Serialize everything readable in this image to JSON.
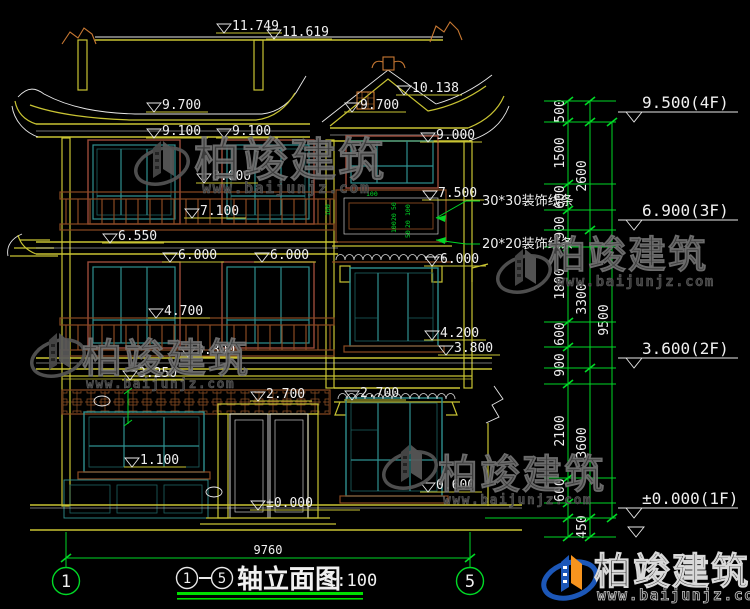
{
  "meta": {
    "drawing_kind": "architectural front elevation, CAD style",
    "sheet_background": "#000000"
  },
  "palette": {
    "bg": "#000000",
    "yellow": "#c8c333",
    "white": "#e8e8e8",
    "green": "#00d926",
    "teal": "#2f8f8f",
    "glass": "#1d6363",
    "maroon": "#9a4a3a",
    "brown": "#8a4a22",
    "orange": "#c87832",
    "wm_gray": "#424242",
    "wm_gray_stroke": "#757575",
    "logo_blue": "#1c57b8",
    "logo_orange": "#f7941e",
    "underline_green": "#00e000",
    "text_white": "#f0f0f0"
  },
  "title": {
    "axis_from": "1",
    "axis_to": "5",
    "name": "轴立面图",
    "scale": "1:100"
  },
  "grid_bubbles": [
    {
      "label": "1",
      "x": 66
    },
    {
      "label": "5",
      "x": 470
    }
  ],
  "bottom_dim": {
    "label": "9760"
  },
  "watermark": {
    "brand": "柏竣建筑",
    "url": "www.baijunjz.com"
  },
  "elevation_marks": [
    {
      "label": "11.749",
      "x": 216,
      "y": 33,
      "len": 66
    },
    {
      "label": "11.619",
      "x": 266,
      "y": 39,
      "len": 66
    },
    {
      "label": "9.700",
      "x": 146,
      "y": 112
    },
    {
      "label": "9.700",
      "x": 344,
      "y": 112
    },
    {
      "label": "10.138",
      "x": 396,
      "y": 95,
      "len": 66
    },
    {
      "label": "9.100",
      "x": 146,
      "y": 138
    },
    {
      "label": "9.100",
      "x": 216,
      "y": 138
    },
    {
      "label": "9.000",
      "x": 420,
      "y": 142
    },
    {
      "label": "8.000",
      "x": 196,
      "y": 183
    },
    {
      "label": "7.500",
      "x": 422,
      "y": 200
    },
    {
      "label": "7.100",
      "x": 184,
      "y": 218
    },
    {
      "label": "6.550",
      "x": 102,
      "y": 243
    },
    {
      "label": "6.000",
      "x": 162,
      "y": 262
    },
    {
      "label": "6.000",
      "x": 254,
      "y": 262
    },
    {
      "label": "6.000",
      "x": 424,
      "y": 266
    },
    {
      "label": "4.700",
      "x": 148,
      "y": 318
    },
    {
      "label": "4.200",
      "x": 424,
      "y": 340
    },
    {
      "label": "3.800",
      "x": 180,
      "y": 357
    },
    {
      "label": "3.800",
      "x": 438,
      "y": 355
    },
    {
      "label": "3.250",
      "x": 122,
      "y": 380
    },
    {
      "label": "2.700",
      "x": 250,
      "y": 401
    },
    {
      "label": "2.700",
      "x": 344,
      "y": 400
    },
    {
      "label": "1.100",
      "x": 124,
      "y": 467
    },
    {
      "label": "0.600",
      "x": 420,
      "y": 492
    },
    {
      "label": "±0.000",
      "x": 250,
      "y": 510,
      "len": 110
    }
  ],
  "leader_notes": [
    {
      "label": "30*30装饰线条",
      "tx": 482,
      "ty": 205,
      "ax": 436,
      "ay": 218
    },
    {
      "label": "20*20装饰线条",
      "tx": 482,
      "ty": 248,
      "ax": 436,
      "ay": 240
    }
  ],
  "level_flags": [
    {
      "label": "9.500(4F)",
      "y": 122
    },
    {
      "label": "6.900(3F)",
      "y": 230
    },
    {
      "label": "3.600(2F)",
      "y": 368
    },
    {
      "label": "±0.000(1F)",
      "y": 518
    }
  ],
  "dim_chains": [
    {
      "x": 568,
      "ticks": [
        101,
        122,
        184,
        210,
        247,
        322,
        347,
        384,
        478,
        503,
        518,
        537
      ],
      "labels": [
        [
          "500",
          111
        ],
        [
          "1500",
          153
        ],
        [
          "600",
          197
        ],
        [
          "900",
          228
        ],
        [
          "1800",
          284
        ],
        [
          "600",
          334
        ],
        [
          "900",
          365
        ],
        [
          "2100",
          431
        ],
        [
          "600",
          490
        ]
      ]
    },
    {
      "x": 590,
      "ticks": [
        101,
        122,
        230,
        368,
        518,
        537
      ],
      "labels": [
        [
          "2600",
          176
        ],
        [
          "3300",
          299
        ],
        [
          "3600",
          443
        ],
        [
          "450",
          527
        ]
      ]
    },
    {
      "x": 612,
      "ticks": [
        122,
        518
      ],
      "labels": [
        [
          "9500",
          320
        ]
      ]
    }
  ],
  "ext_lines": {
    "x1": 544,
    "x2": 616,
    "ys": [
      101,
      122,
      184,
      210,
      230,
      247,
      322,
      347,
      368,
      384,
      478,
      503,
      518,
      537
    ]
  },
  "detail_dims": [
    [
      "100",
      330,
      216,
      -90
    ],
    [
      "100",
      366,
      196,
      0
    ],
    [
      "50",
      396,
      210,
      -90
    ],
    [
      "20",
      396,
      221,
      -90
    ],
    [
      "100",
      396,
      233,
      -90
    ],
    [
      "100",
      410,
      216,
      -90
    ],
    [
      "20",
      410,
      228,
      -90
    ],
    [
      "50",
      410,
      238,
      -90
    ]
  ],
  "watermarks": [
    {
      "mode": "gray",
      "logo": [
        162,
        160
      ],
      "brand": [
        194,
        176,
        46
      ],
      "url": [
        202,
        193,
        15
      ]
    },
    {
      "mode": "gray",
      "logo": [
        58,
        352
      ],
      "brand": [
        82,
        372,
        40
      ],
      "url": [
        86,
        388,
        13
      ]
    },
    {
      "mode": "gray",
      "logo": [
        410,
        464
      ],
      "brand": [
        438,
        488,
        40
      ],
      "url": [
        443,
        504,
        13
      ]
    },
    {
      "mode": "gray",
      "logo": [
        524,
        268
      ],
      "brand": [
        548,
        268,
        38
      ],
      "url": [
        556,
        286,
        14
      ]
    },
    {
      "mode": "color",
      "logo": [
        570,
        574
      ],
      "brand": [
        594,
        584,
        37
      ],
      "url": [
        597,
        600,
        15
      ]
    }
  ],
  "scallop_rows": [
    {
      "x1": 336,
      "x2": 450,
      "y": 260,
      "r": 4.5
    },
    {
      "x1": 338,
      "x2": 458,
      "y": 399,
      "r": 4.5
    }
  ]
}
